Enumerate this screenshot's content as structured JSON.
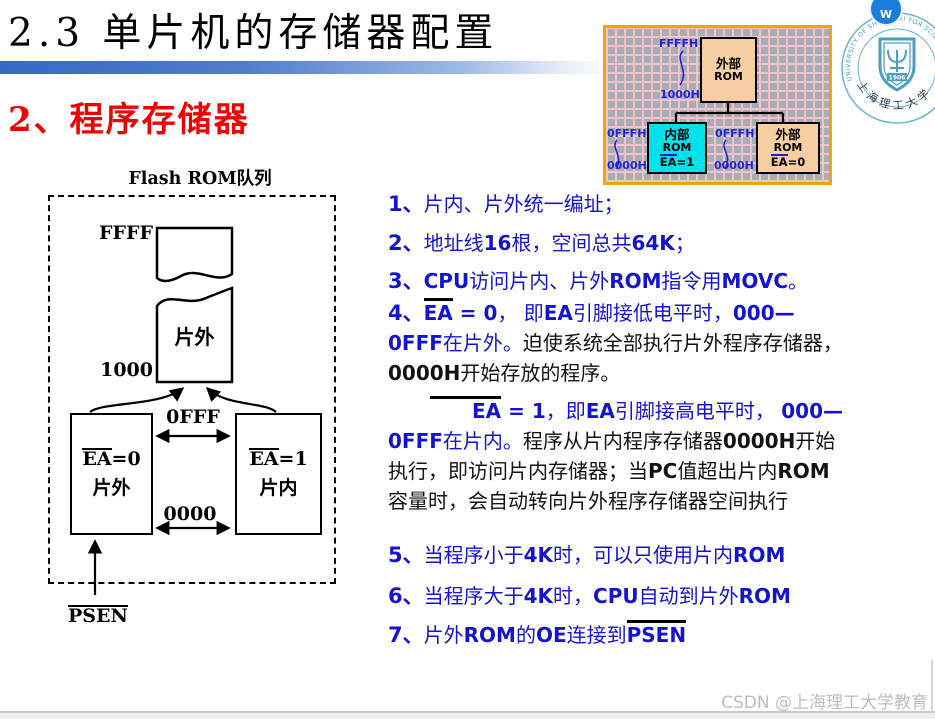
{
  "page": {
    "title": "2.3  单片机的存储器配置",
    "subtitle": "2、程序存储器",
    "watermark": "CSDN @上海理工大学教育"
  },
  "mini_diagram": {
    "ffffh": "FFFFH",
    "addr1000h": "1000H",
    "left_offfh": "0FFFH",
    "left_0000h": "0000H",
    "mid_offfh": "0FFFH",
    "mid_0000h": "0000H",
    "ext_rom_top": {
      "l1": "外部",
      "l2": "ROM"
    },
    "int_rom": {
      "l1": "内部",
      "l2": "ROM",
      "ea": "EA",
      "rest": "=1"
    },
    "ext_rom_bot": {
      "l1": "外部",
      "l2": "ROM",
      "ea": "EA",
      "rest": "=0"
    }
  },
  "flash_diagram": {
    "title": "Flash ROM队列",
    "labels": {
      "ffff": "FFFF",
      "addr1000": "1000",
      "offf": "0FFF",
      "addr0000": "0000",
      "offchip": "片外",
      "psen": "PSEN"
    },
    "left_box": {
      "ea": "EA",
      "rest": "=0",
      "name": "片外"
    },
    "right_box": {
      "ea": "EA",
      "rest": "=1",
      "name": "片内"
    }
  },
  "notes": {
    "items": [
      {
        "segments": [
          {
            "k": "num",
            "t": "1、"
          },
          {
            "k": "zh",
            "t": "片内、片外统一编址；"
          }
        ]
      },
      {
        "segments": [
          {
            "k": "num",
            "t": "2、"
          },
          {
            "k": "zh",
            "t": "地址线"
          },
          {
            "k": "lat",
            "t": "16"
          },
          {
            "k": "zh",
            "t": "根，空间总共"
          },
          {
            "k": "lat",
            "t": "64K"
          },
          {
            "k": "zh",
            "t": "；"
          }
        ]
      },
      {
        "segments": [
          {
            "k": "num",
            "t": "3、"
          },
          {
            "k": "lat",
            "t": "CPU"
          },
          {
            "k": "zh",
            "t": "访问片内、片外"
          },
          {
            "k": "lat",
            "t": "ROM"
          },
          {
            "k": "zh",
            "t": "指令用"
          },
          {
            "k": "lat",
            "t": "MOVC"
          },
          {
            "k": "zh",
            "t": "。"
          }
        ]
      },
      {
        "segments": [
          {
            "k": "num",
            "t": "4、"
          },
          {
            "k": "latol",
            "t": "EA"
          },
          {
            "k": "lat",
            "t": " = 0"
          },
          {
            "k": "zh",
            "t": "， 即"
          },
          {
            "k": "lat",
            "t": "EA"
          },
          {
            "k": "zh",
            "t": "引脚接低电平时，"
          },
          {
            "k": "lat",
            "t": "000—"
          },
          {
            "k": "br"
          },
          {
            "k": "lat",
            "t": "0FFF"
          },
          {
            "k": "zh",
            "t": "在片外。"
          },
          {
            "k": "zhk",
            "t": "迫使系统全部执行片外程序存储器，"
          },
          {
            "k": "br"
          },
          {
            "k": "latk",
            "t": "0000H"
          },
          {
            "k": "zhk",
            "t": "开始存放的程序。"
          }
        ]
      },
      {
        "segments": [
          {
            "k": "latol",
            "t": "EA"
          },
          {
            "k": "lat",
            "t": " = 1"
          },
          {
            "k": "zh",
            "t": "，即"
          },
          {
            "k": "lat",
            "t": "EA"
          },
          {
            "k": "zh",
            "t": "引脚接高电平时， "
          },
          {
            "k": "lat",
            "t": "000—"
          },
          {
            "k": "br"
          },
          {
            "k": "lat",
            "t": "0FFF"
          },
          {
            "k": "zh",
            "t": "在片内。"
          },
          {
            "k": "zhk",
            "t": "程序从片内程序存储器"
          },
          {
            "k": "latk",
            "t": "0000H"
          },
          {
            "k": "zhk",
            "t": "开始"
          },
          {
            "k": "br"
          },
          {
            "k": "zhk",
            "t": "执行，即访问片内存储器；当"
          },
          {
            "k": "latk",
            "t": "PC"
          },
          {
            "k": "zhk",
            "t": "值超出片内"
          },
          {
            "k": "latk",
            "t": "ROM"
          },
          {
            "k": "br"
          },
          {
            "k": "zhk",
            "t": "容量时，会自动转向片外程序存储器空间执行"
          }
        ]
      },
      {
        "segments": [
          {
            "k": "num",
            "t": "5、"
          },
          {
            "k": "zh",
            "t": "当程序小于"
          },
          {
            "k": "lat",
            "t": "4K"
          },
          {
            "k": "zh",
            "t": "时，可以只使用片内"
          },
          {
            "k": "lat",
            "t": "ROM"
          }
        ]
      },
      {
        "segments": [
          {
            "k": "num",
            "t": "6、"
          },
          {
            "k": "zh",
            "t": "当程序大于"
          },
          {
            "k": "lat",
            "t": "4K"
          },
          {
            "k": "zh",
            "t": "时，"
          },
          {
            "k": "lat",
            "t": "CPU"
          },
          {
            "k": "zh",
            "t": "自动到片外"
          },
          {
            "k": "lat",
            "t": "ROM"
          }
        ]
      },
      {
        "segments": [
          {
            "k": "num",
            "t": "7、"
          },
          {
            "k": "zh",
            "t": "片外"
          },
          {
            "k": "lat",
            "t": "ROM"
          },
          {
            "k": "zh",
            "t": "的"
          },
          {
            "k": "lat",
            "t": "OE"
          },
          {
            "k": "zh",
            "t": "连接到"
          },
          {
            "k": "latol",
            "t": "PSEN"
          }
        ]
      }
    ]
  },
  "logo": {
    "arc_text": "UNIVERSITY OF SHANGHAI FOR SCIENCE AND TECHNOLOGY",
    "year": "1906",
    "cn_name": "上海理工大学",
    "badge": "W"
  },
  "colors": {
    "note_blue": "#1414CE",
    "accent_red": "#F00000",
    "bar_blue": "#3767C1",
    "box_peach": "#F6CEA2",
    "box_cyan": "#00E2EA",
    "grid_border_orange": "#F0A500"
  }
}
